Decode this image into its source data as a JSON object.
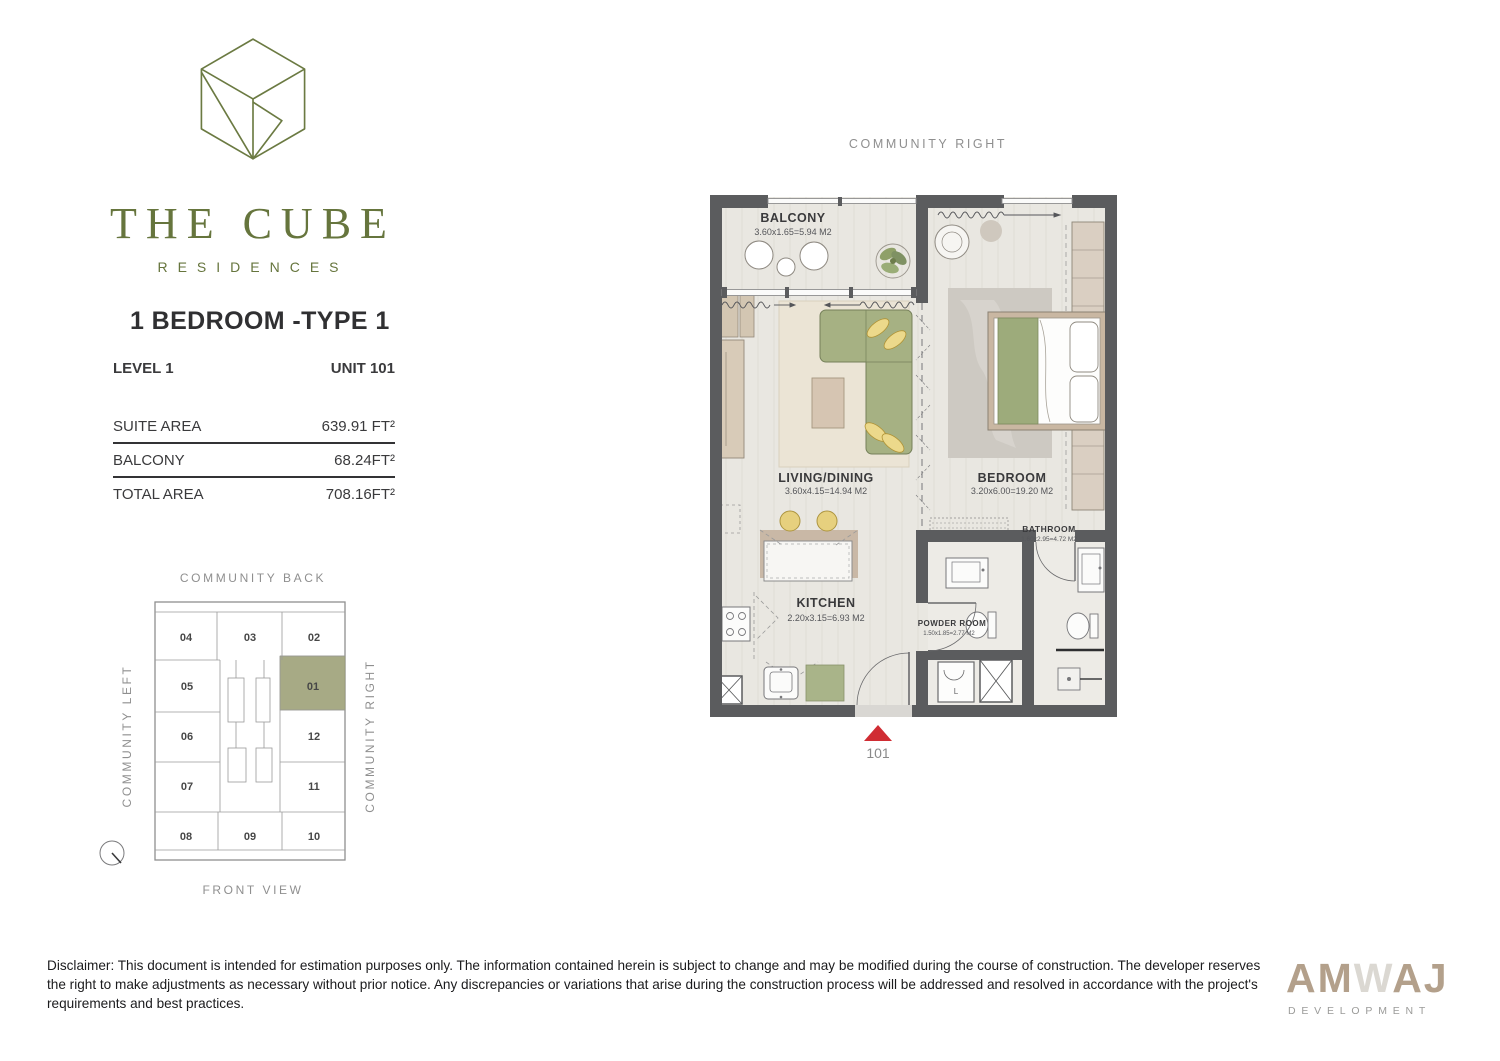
{
  "brand": {
    "name": "THE CUBE",
    "subtitle": "RESIDENCES"
  },
  "unit": {
    "title": "1 BEDROOM -TYPE 1",
    "level": "LEVEL 1",
    "unit_no": "UNIT 101",
    "areas": [
      {
        "label": "SUITE AREA",
        "value": "639.91 FT²"
      },
      {
        "label": "BALCONY",
        "value": "68.24FT²"
      },
      {
        "label": "TOTAL AREA",
        "value": "708.16FT²"
      }
    ]
  },
  "key_plan": {
    "top_label": "COMMUNITY BACK",
    "bottom_label": "FRONT VIEW",
    "left_label": "COMMUNITY LEFT",
    "right_label": "COMMUNITY RIGHT",
    "highlighted_unit": "01",
    "units": [
      "04",
      "03",
      "02",
      "05",
      "01",
      "06",
      "12",
      "07",
      "11",
      "08",
      "09",
      "10"
    ]
  },
  "floor_plan": {
    "orientation_label": "COMMUNITY RIGHT",
    "entrance": "101",
    "washer_label": "L",
    "rooms": [
      {
        "name": "BALCONY",
        "dims": "3.60x1.65=5.94 M2"
      },
      {
        "name": "LIVING/DINING",
        "dims": "3.60x4.15=14.94 M2"
      },
      {
        "name": "BEDROOM",
        "dims": "3.20x6.00=19.20 M2"
      },
      {
        "name": "KITCHEN",
        "dims": "2.20x3.15=6.93 M2"
      },
      {
        "name": "POWDER ROOM",
        "dims": "1.50x1.85=2.77 M2"
      },
      {
        "name": "BATHROOM",
        "dims": "1.60x2.95=4.72 M2"
      }
    ]
  },
  "footer": {
    "disclaimer": "Disclaimer: This document is intended for estimation purposes only. The information contained herein is subject to change and may be modified during the course of construction. The developer reserves the right to make adjustments as necessary without prior notice. Any discrepancies or variations that arise during the construction process will be addressed and resolved in accordance with the project's requirements and best practices.",
    "developer": {
      "parts": [
        "AM",
        "W",
        "AJ"
      ],
      "subtitle": "DEVELOPMENT"
    }
  },
  "colors": {
    "accent_olive": "#66753d",
    "wall": "#5b5c5e",
    "unit_highlight": "#a7aa85",
    "entrance_marker": "#d02c33"
  }
}
